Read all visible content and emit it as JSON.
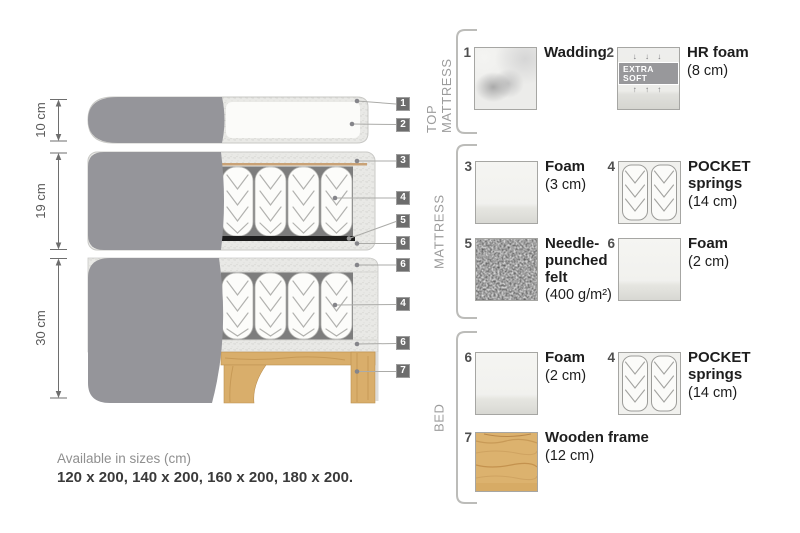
{
  "diagram": {
    "dimensions": [
      {
        "label": "10 cm"
      },
      {
        "label": "19 cm"
      },
      {
        "label": "30 cm"
      }
    ],
    "callouts": [
      "1",
      "2",
      "3",
      "4",
      "5",
      "6",
      "6",
      "4",
      "6",
      "7"
    ]
  },
  "legend": {
    "sections": [
      {
        "title": "TOP MATTRESS",
        "items": [
          {
            "num": "1",
            "name": "Wadding",
            "dim": ""
          },
          {
            "num": "2",
            "name": "HR foam",
            "dim": "(8 cm)",
            "badge": "EXTRA SOFT",
            "arrows_down": "↓ ↓ ↓",
            "arrows_up": "↑ ↑ ↑"
          }
        ]
      },
      {
        "title": "MATTRESS",
        "items": [
          {
            "num": "3",
            "name": "Foam",
            "dim": "(3 cm)"
          },
          {
            "num": "4",
            "name": "POCKET springs",
            "dim": "(14 cm)"
          },
          {
            "num": "5",
            "name": "Needle-punched felt",
            "dim": "(400 g/m²)"
          },
          {
            "num": "6",
            "name": "Foam",
            "dim": "(2 cm)"
          }
        ]
      },
      {
        "title": "BED",
        "items": [
          {
            "num": "6",
            "name": "Foam",
            "dim": "(2 cm)"
          },
          {
            "num": "4",
            "name": "POCKET springs",
            "dim": "(14 cm)"
          },
          {
            "num": "7",
            "name": "Wooden frame",
            "dim": "(12 cm)"
          }
        ]
      }
    ]
  },
  "footer": {
    "sizes_title": "Available in sizes (cm)",
    "sizes_list": "120 x 200, 140 x 200, 160 x 200, 180 x 200."
  },
  "colors": {
    "fabric_grey": "#95959A",
    "foam_light": "#EAEAE7",
    "wood": "#DCB26E",
    "felt_dark": "#666666",
    "callout_tag": "#6D6D6D",
    "text_dark": "#1D1D1D",
    "text_muted": "#8F8F8F"
  }
}
